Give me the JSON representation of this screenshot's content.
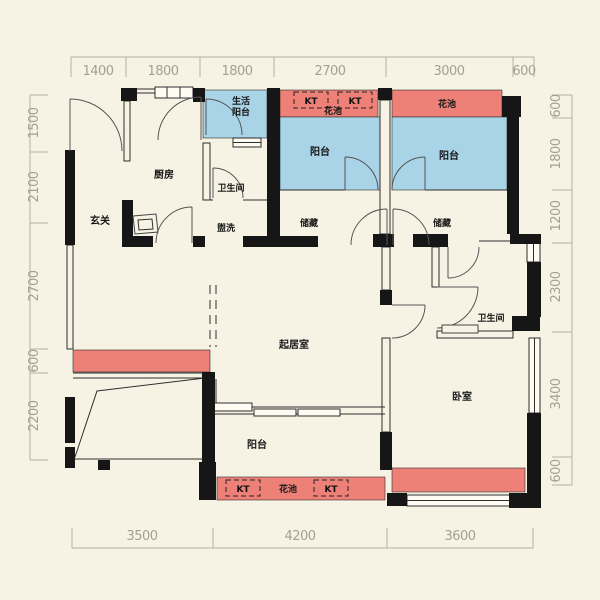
{
  "colors": {
    "background": "#f7f3e4",
    "wall": "#161616",
    "flower_bed": "#ed8077",
    "balcony": "#a9d3e6",
    "dimension_text": "#a49f92"
  },
  "dims": {
    "top": [
      "1400",
      "1800",
      "1800",
      "2700",
      "3000",
      "600"
    ],
    "bottom": [
      "3500",
      "4200",
      "3600"
    ],
    "left": [
      "1500",
      "2100",
      "2700",
      "600",
      "2200"
    ],
    "right": [
      "600",
      "1800",
      "1200",
      "2300",
      "3400",
      "600"
    ]
  },
  "labels": {
    "entry": "玄关",
    "kitchen": "厨房",
    "bathroom_top": "卫生间",
    "washing": "盥洗",
    "service_balcony_line1": "生活",
    "service_balcony_line2": "阳台",
    "flower_bed_top_center": "花池",
    "flower_bed_top_right": "花池",
    "balcony_top_center": "阳台",
    "balcony_top_right": "阳台",
    "storage_center": "储藏",
    "storage_right": "储藏",
    "living_room": "起居室",
    "bathroom_right": "卫生间",
    "bedroom": "卧室",
    "balcony_bottom": "阳台",
    "flower_bed_bottom": "花池",
    "ac_unit": "KT"
  }
}
